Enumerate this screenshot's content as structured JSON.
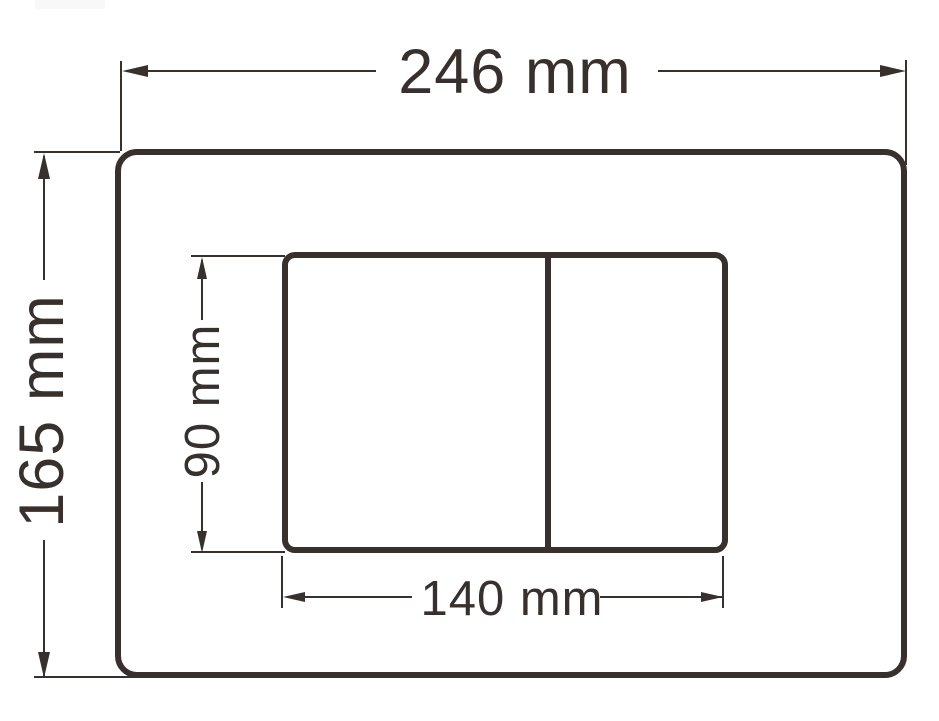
{
  "drawing": {
    "kind": "technical-dimension-drawing",
    "subject": "dual-flush-plate-front-view",
    "colors": {
      "stroke": "#37302d",
      "background": "#ffffff"
    },
    "dimensions": {
      "plate_width": {
        "value": 246,
        "unit": "mm",
        "label": "246 mm"
      },
      "plate_height": {
        "value": 165,
        "unit": "mm",
        "label": "165 mm"
      },
      "buttons_height": {
        "value": 90,
        "unit": "mm",
        "label": "90 mm"
      },
      "buttons_width": {
        "value": 140,
        "unit": "mm",
        "label": "140 mm"
      }
    }
  }
}
